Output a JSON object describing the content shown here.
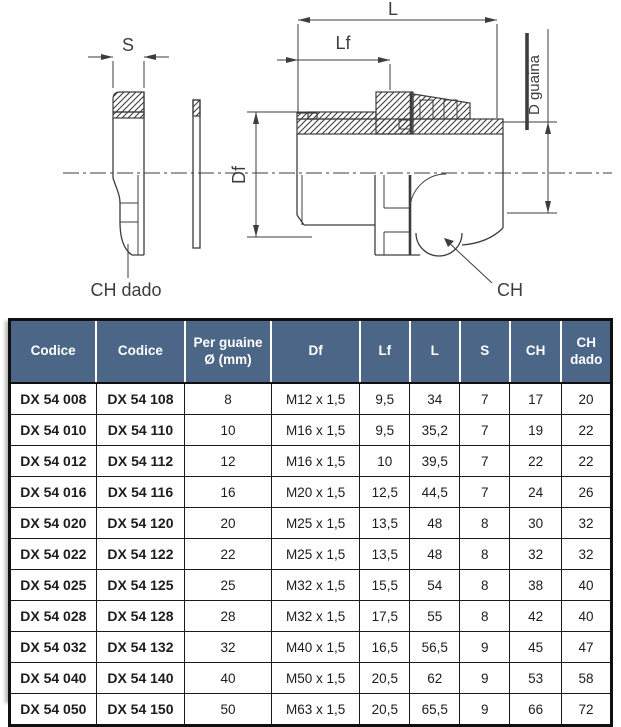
{
  "drawing": {
    "labels": {
      "s": "S",
      "l": "L",
      "lf": "Lf",
      "df": "Df",
      "d_guaina": "D guaina",
      "ch": "CH",
      "ch_dado": "CH dado"
    }
  },
  "table": {
    "colors": {
      "header_bg": "#4b6687",
      "header_text": "#ffffff",
      "border": "#101010",
      "cell_text": "#1c1c1c"
    },
    "columns": [
      {
        "label": "Codice"
      },
      {
        "label": "Codice"
      },
      {
        "label": "Per guaine\nØ (mm)"
      },
      {
        "label": "Df"
      },
      {
        "label": "Lf"
      },
      {
        "label": "L"
      },
      {
        "label": "S"
      },
      {
        "label": "CH"
      },
      {
        "label": "CH\ndado"
      }
    ],
    "rows": [
      [
        "DX 54 008",
        "DX 54 108",
        "8",
        "M12 x 1,5",
        "9,5",
        "34",
        "7",
        "17",
        "20"
      ],
      [
        "DX 54 010",
        "DX 54 110",
        "10",
        "M16 x 1,5",
        "9,5",
        "35,2",
        "7",
        "19",
        "22"
      ],
      [
        "DX 54 012",
        "DX 54 112",
        "12",
        "M16 x 1,5",
        "10",
        "39,5",
        "7",
        "22",
        "22"
      ],
      [
        "DX 54 016",
        "DX 54 116",
        "16",
        "M20 x 1,5",
        "12,5",
        "44,5",
        "7",
        "24",
        "26"
      ],
      [
        "DX 54 020",
        "DX 54 120",
        "20",
        "M25 x 1,5",
        "13,5",
        "48",
        "8",
        "30",
        "32"
      ],
      [
        "DX 54 022",
        "DX 54 122",
        "22",
        "M25 x 1,5",
        "13,5",
        "48",
        "8",
        "32",
        "32"
      ],
      [
        "DX 54 025",
        "DX 54 125",
        "25",
        "M32 x 1,5",
        "15,5",
        "54",
        "8",
        "38",
        "40"
      ],
      [
        "DX 54 028",
        "DX 54 128",
        "28",
        "M32 x 1,5",
        "17,5",
        "55",
        "8",
        "42",
        "40"
      ],
      [
        "DX 54 032",
        "DX 54 132",
        "32",
        "M40 x 1,5",
        "16,5",
        "56,5",
        "9",
        "45",
        "47"
      ],
      [
        "DX 54 040",
        "DX 54 140",
        "40",
        "M50 x 1,5",
        "20,5",
        "62",
        "9",
        "53",
        "58"
      ],
      [
        "DX 54 050",
        "DX 54 150",
        "50",
        "M63 x 1,5",
        "20,5",
        "65,5",
        "9",
        "66",
        "72"
      ]
    ]
  }
}
